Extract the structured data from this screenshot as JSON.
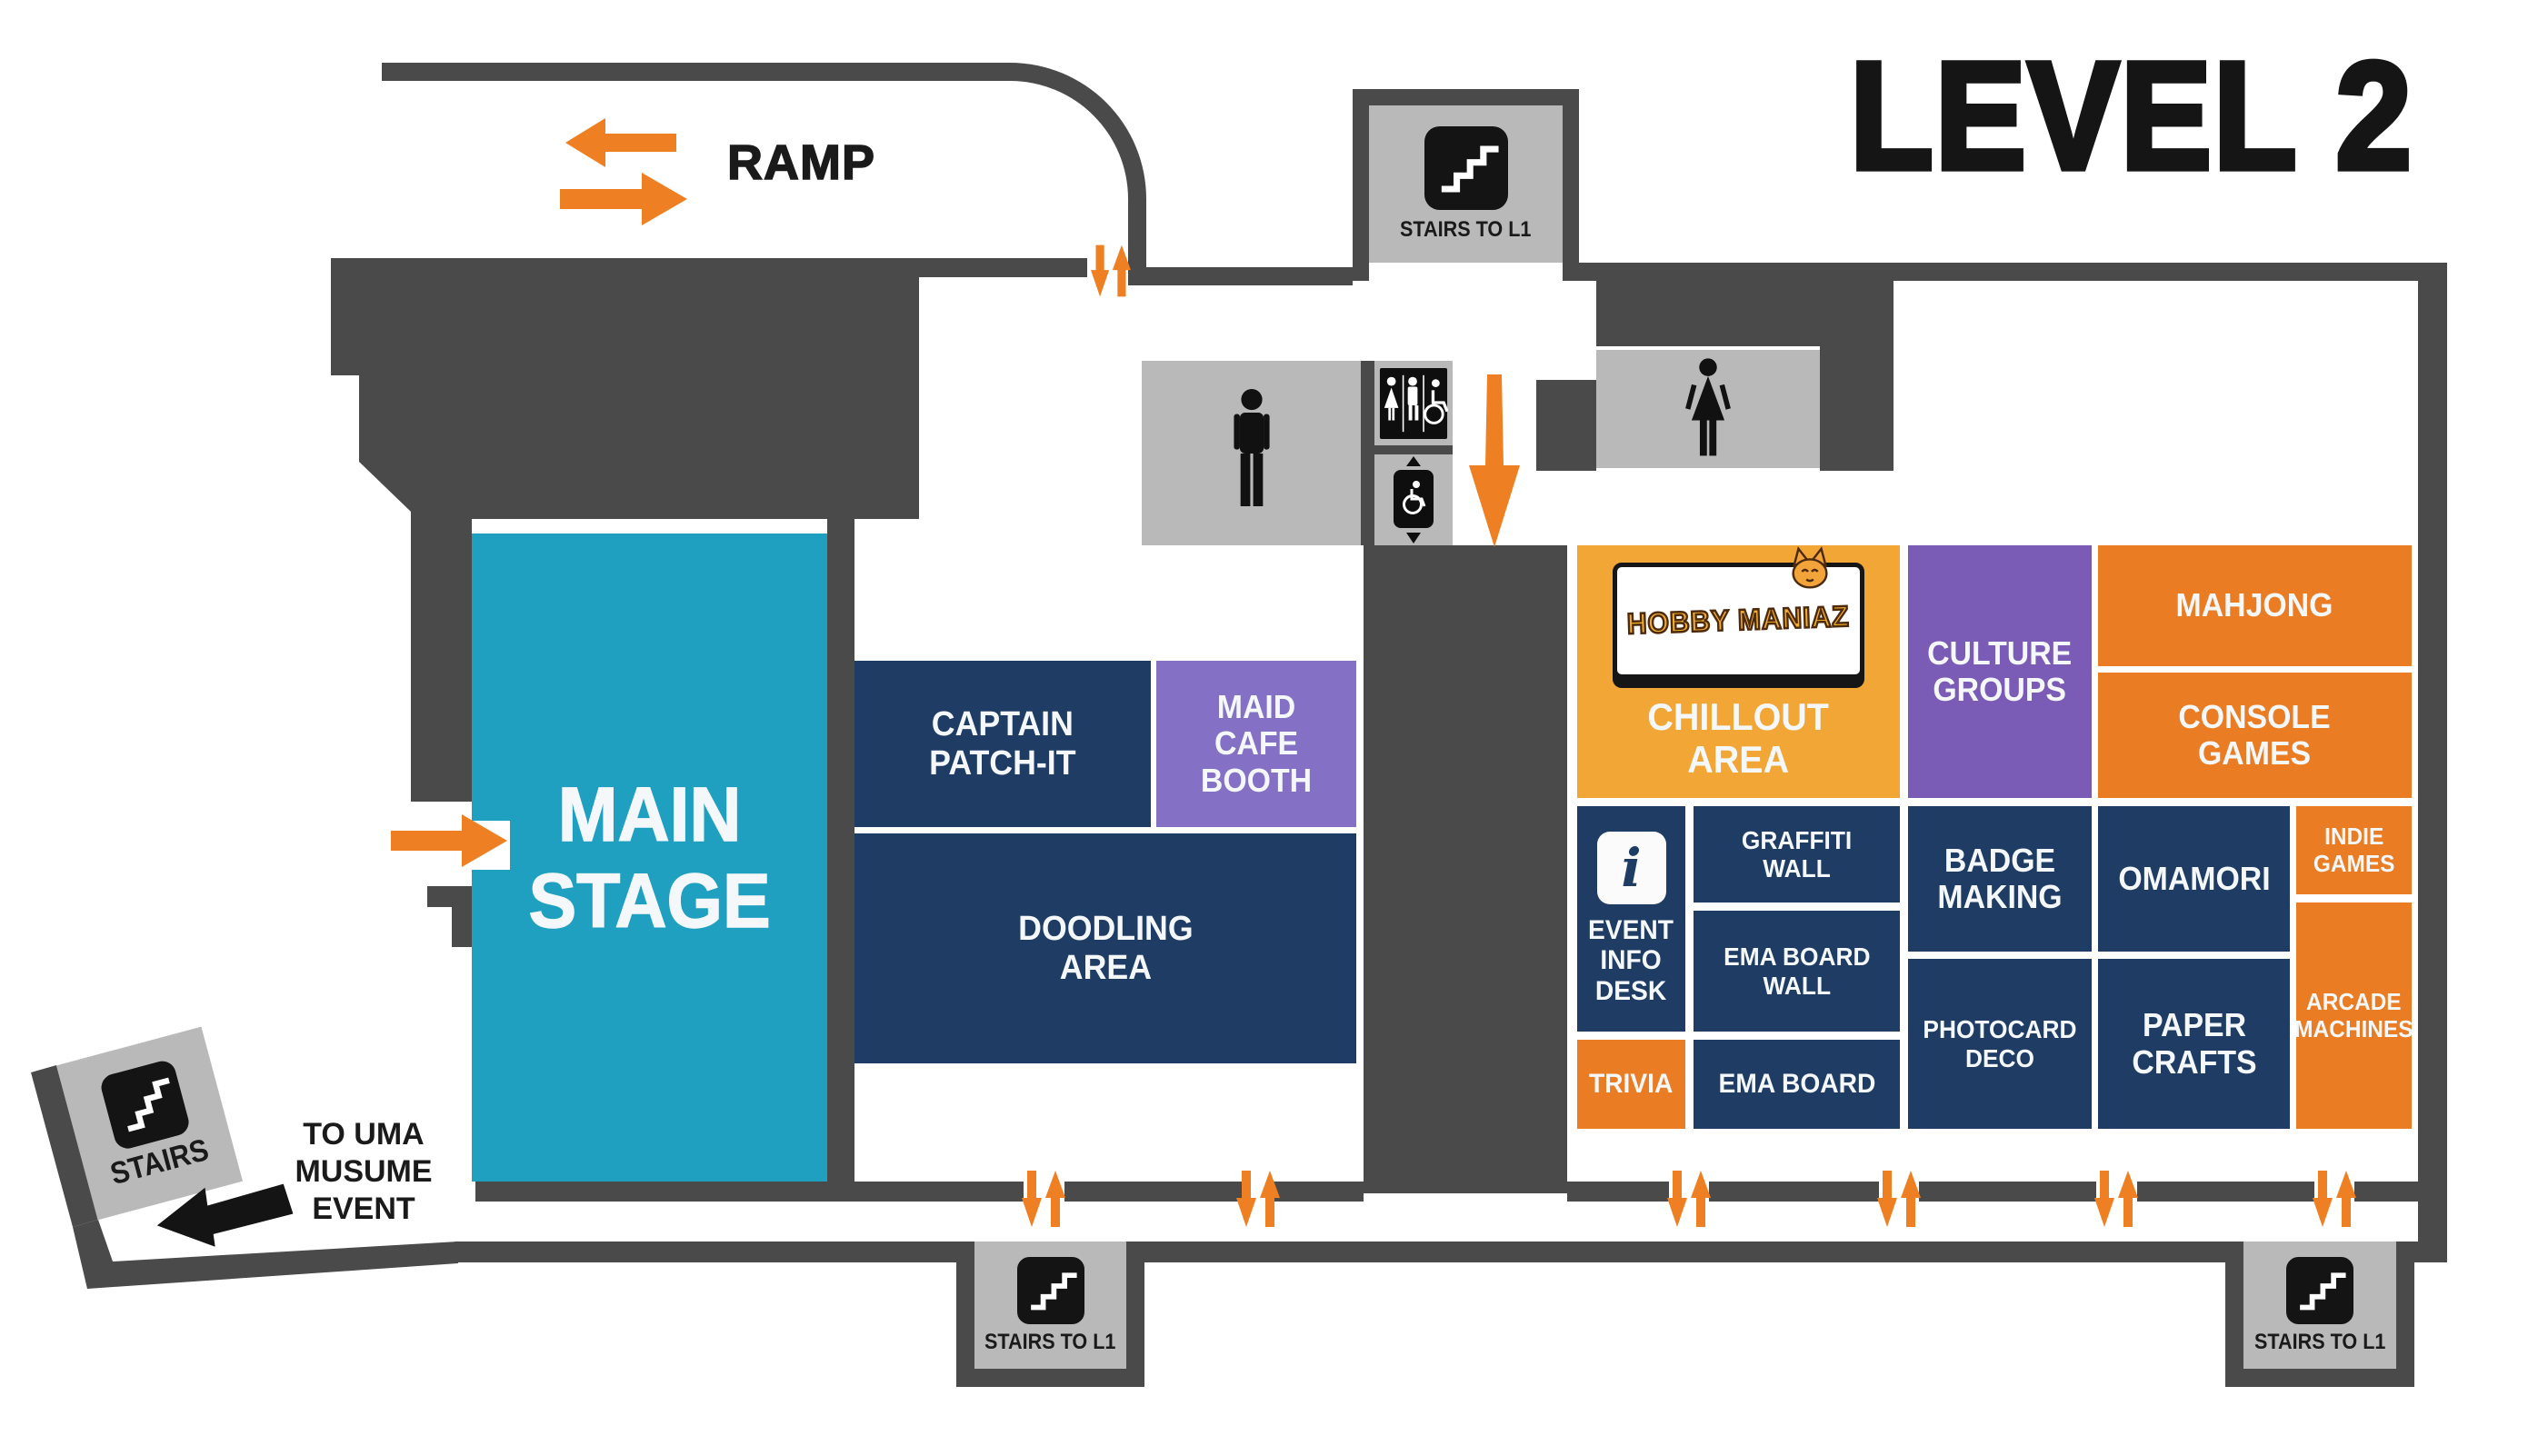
{
  "title": "LEVEL 2",
  "navigation": {
    "ramp": "RAMP",
    "stairs_top": "STAIRS TO L1",
    "stairs_bottom_center": "STAIRS TO L1",
    "stairs_bottom_right": "STAIRS TO L1",
    "stairs_side": "STAIRS",
    "uma_event": "TO UMA\nMUSUME\nEVENT"
  },
  "zones": {
    "main_stage": "MAIN\nSTAGE",
    "captain_patch_it": "CAPTAIN\nPATCH-IT",
    "maid_cafe_booth": "MAID\nCAFE\nBOOTH",
    "doodling_area": "DOODLING\nAREA",
    "chillout_area": "CHILLOUT\nAREA",
    "culture_groups": "CULTURE\nGROUPS",
    "mahjong": "MAHJONG",
    "console_games": "CONSOLE\nGAMES",
    "event_info_desk": "EVENT\nINFO\nDESK",
    "graffiti_wall": "GRAFFITI\nWALL",
    "ema_board_wall": "EMA BOARD\nWALL",
    "trivia": "TRIVIA",
    "ema_board": "EMA BOARD",
    "badge_making": "BADGE\nMAKING",
    "omamori": "OMAMORI",
    "indie_games": "INDIE\nGAMES",
    "arcade_machines": "ARCADE\nMACHINES",
    "photocard_deco": "PHOTOCARD\nDECO",
    "paper_crafts": "PAPER\nCRAFTS"
  },
  "logo": {
    "brand": "HOBBY MANIAZ"
  },
  "icons": {
    "info_glyph": "i"
  },
  "colors": {
    "wall": "#4a4a4a",
    "navy": "#1e3c64",
    "orange": "#ea7d23",
    "amber": "#f2a636",
    "purple": "#7a5cb6",
    "lavender": "#8471c5",
    "teal": "#1fa0c0",
    "gray_box": "#b9b9b9",
    "arrow_orange": "#ee7f22",
    "text_dark": "#1a1a1a",
    "logo_yellow": "#f3b02c"
  }
}
